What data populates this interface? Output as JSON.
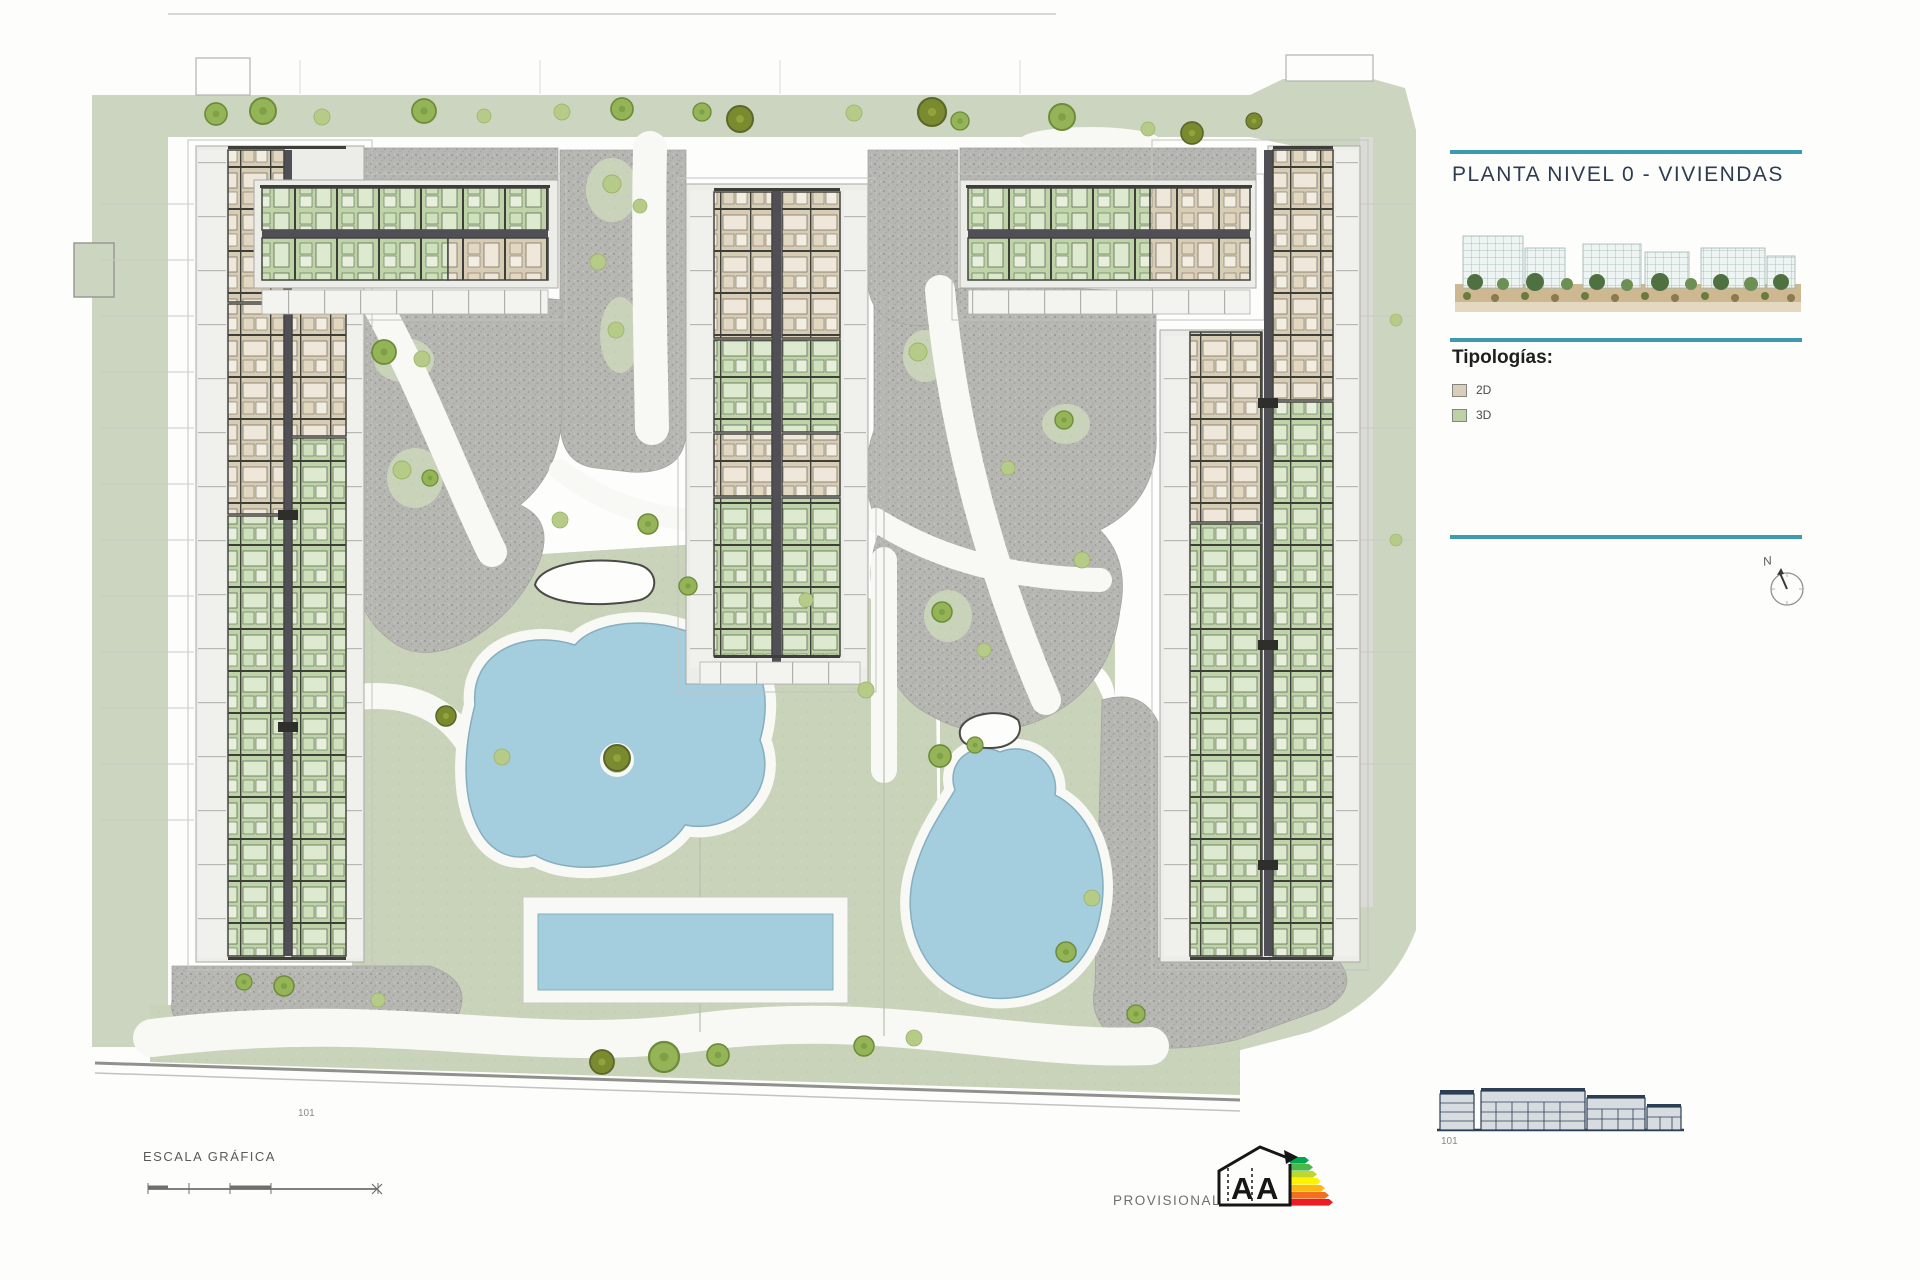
{
  "panel": {
    "title": "PLANTA NIVEL 0 - VIVIENDAS",
    "accent_line_color": "#3e9aae",
    "thumbnail_alt": "aerial-render-of-residential-complex",
    "legend_title": "Tipologías:",
    "legend": [
      {
        "label": "2D",
        "swatch_color": "#d9cfb8"
      },
      {
        "label": "3D",
        "swatch_color": "#bcd2a6"
      }
    ],
    "compass": {
      "label": "N",
      "icon": "north-compass-icon"
    }
  },
  "plan": {
    "site_label": "101",
    "typology_2d_color": "#d7ccb4",
    "typology_3d_color": "#bed3a8",
    "water_color": "#a4cddd",
    "grass_color": "#c9d3ba",
    "gravel_color": "#b6b6b2"
  },
  "footer": {
    "scale_label": "ESCALA GRÁFICA",
    "provisional_label": "PROVISIONAL",
    "elevation_label": "101",
    "energy_certificate": {
      "letter_left": "A",
      "letter_right": "A",
      "bar_colors": [
        "#00a651",
        "#4cb847",
        "#bed630",
        "#fff200",
        "#fdb913",
        "#f37021",
        "#ed1c24"
      ]
    }
  }
}
